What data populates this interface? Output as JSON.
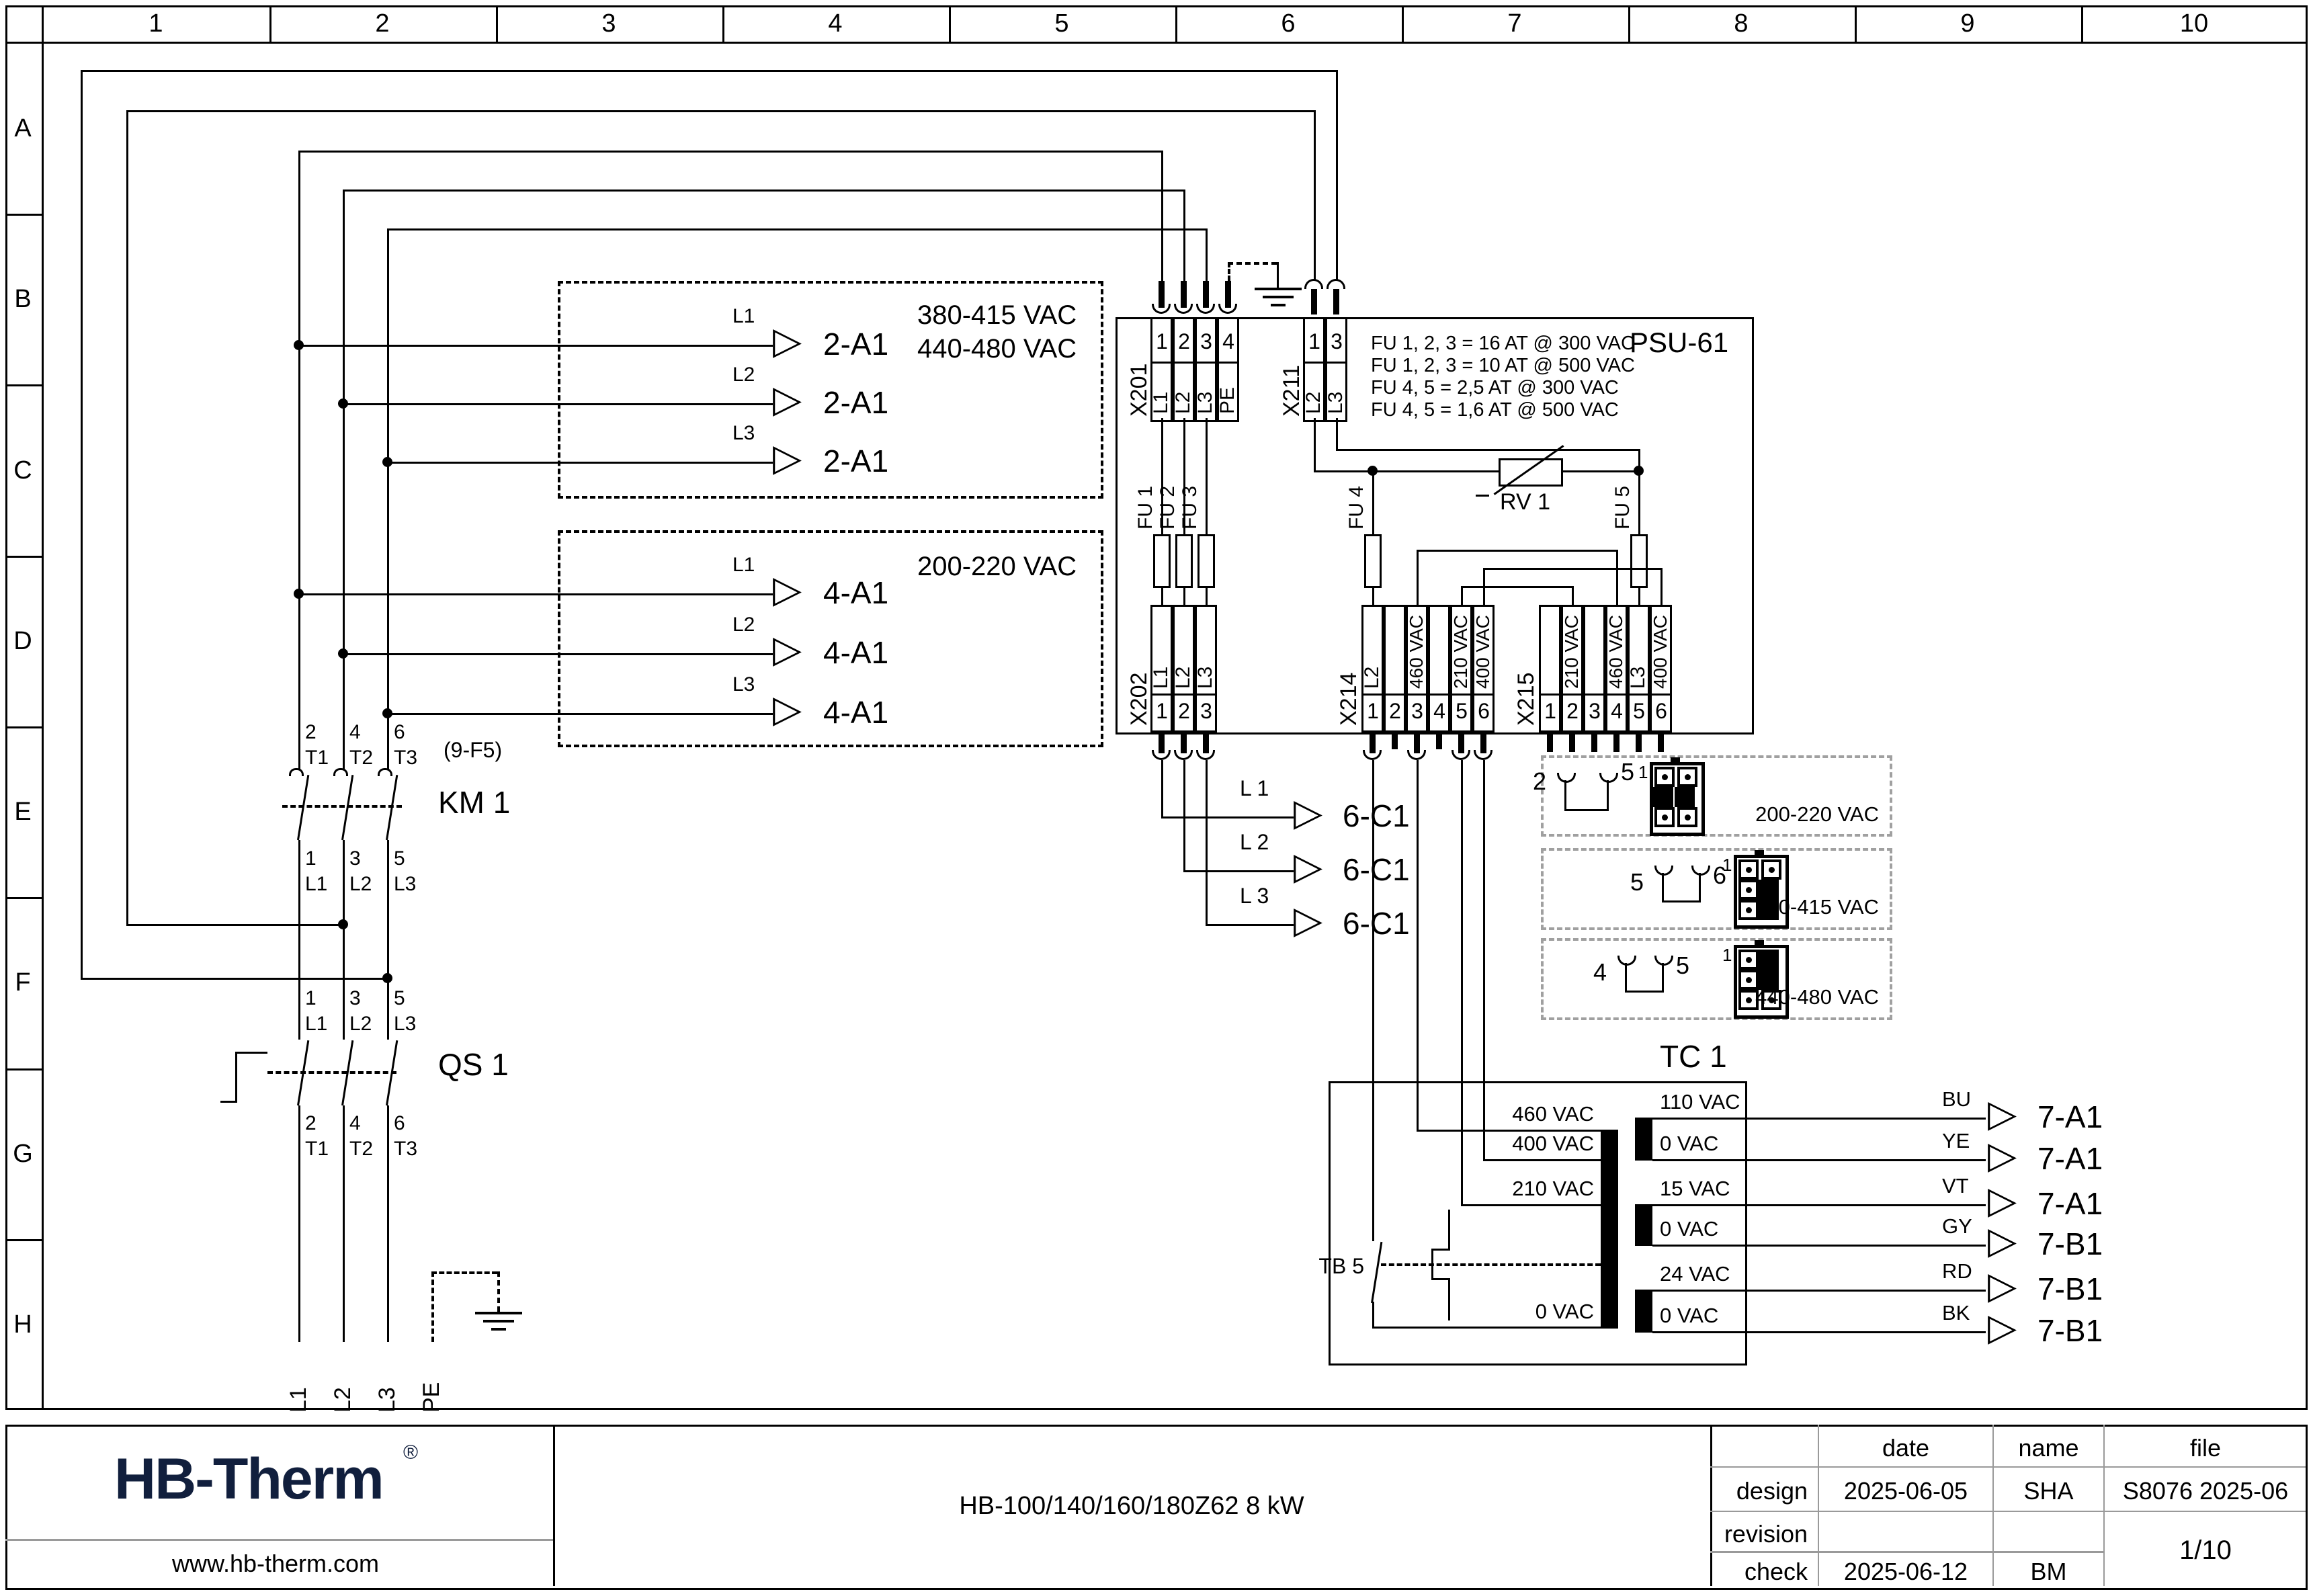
{
  "icons": {
    "arrow": "▷",
    "reg": "®"
  },
  "sheet": {
    "columns": [
      "1",
      "2",
      "3",
      "4",
      "5",
      "6",
      "7",
      "8",
      "9",
      "10"
    ],
    "rows": [
      "A",
      "B",
      "C",
      "D",
      "E",
      "F",
      "G",
      "H"
    ]
  },
  "box_2a1": {
    "rows": [
      {
        "phase": "L1",
        "tag": "2-A1"
      },
      {
        "phase": "L2",
        "tag": "2-A1"
      },
      {
        "phase": "L3",
        "tag": "2-A1"
      }
    ],
    "voltages": [
      "380-415 VAC",
      "440-480 VAC"
    ]
  },
  "box_4a1": {
    "rows": [
      {
        "phase": "L1",
        "tag": "4-A1"
      },
      {
        "phase": "L2",
        "tag": "4-A1"
      },
      {
        "phase": "L3",
        "tag": "4-A1"
      }
    ],
    "voltages": [
      "200-220 VAC"
    ]
  },
  "km1": {
    "ref": "(9-F5)",
    "name": "KM 1",
    "top": [
      {
        "pin": "2",
        "term": "T1"
      },
      {
        "pin": "4",
        "term": "T2"
      },
      {
        "pin": "6",
        "term": "T3"
      }
    ],
    "bottom": [
      {
        "pin": "1",
        "term": "L1"
      },
      {
        "pin": "3",
        "term": "L2"
      },
      {
        "pin": "5",
        "term": "L3"
      }
    ]
  },
  "qs1": {
    "name": "QS 1",
    "top": [
      {
        "pin": "1",
        "term": "L1"
      },
      {
        "pin": "3",
        "term": "L2"
      },
      {
        "pin": "5",
        "term": "L3"
      }
    ],
    "bottom": [
      {
        "pin": "2",
        "term": "T1"
      },
      {
        "pin": "4",
        "term": "T2"
      },
      {
        "pin": "6",
        "term": "T3"
      }
    ]
  },
  "mains": {
    "l1": "L1",
    "l2": "L2",
    "l3": "L3",
    "pe": "PE"
  },
  "psu": {
    "name": "PSU-61",
    "fuse_notes": [
      "FU 1, 2, 3 = 16 AT @ 300 VAC",
      "FU 1, 2, 3 = 10 AT @ 500 VAC",
      "FU 4, 5 = 2,5 AT @ 300 VAC",
      "FU 4, 5 = 1,6 AT @ 500 VAC"
    ],
    "x201": {
      "name": "X201",
      "pins": [
        "1",
        "2",
        "3",
        "4"
      ],
      "labels": [
        "L1",
        "L2",
        "L3",
        "PE"
      ]
    },
    "x211": {
      "name": "X211",
      "pins": [
        "1",
        "3"
      ],
      "labels": [
        "L2",
        "L3"
      ]
    },
    "x202": {
      "name": "X202",
      "pins": [
        "1",
        "2",
        "3"
      ],
      "labels": [
        "L1",
        "L2",
        "L3"
      ]
    },
    "x214": {
      "name": "X214",
      "pins": [
        "1",
        "2",
        "3",
        "4",
        "5",
        "6"
      ],
      "labels": [
        "L2",
        "",
        "460 VAC",
        "",
        "210 VAC",
        "400 VAC"
      ]
    },
    "x215": {
      "name": "X215",
      "pins": [
        "1",
        "2",
        "3",
        "4",
        "5",
        "6"
      ],
      "labels": [
        "",
        "210 VAC",
        "",
        "460 VAC",
        "L3",
        "400 VAC"
      ]
    },
    "fu1": "FU 1",
    "fu2": "FU 2",
    "fu3": "FU 3",
    "fu4": "FU 4",
    "fu5": "FU 5",
    "rv1": "RV 1"
  },
  "c6": {
    "rows": [
      {
        "phase": "L 1",
        "tag": "6-C1"
      },
      {
        "phase": "L 2",
        "tag": "6-C1"
      },
      {
        "phase": "L 3",
        "tag": "6-C1"
      }
    ]
  },
  "selectors": [
    {
      "pins": [
        "2",
        "5"
      ],
      "conn_pin": "1",
      "voltage": "200-220 VAC"
    },
    {
      "pins": [
        "5",
        "6"
      ],
      "conn_pin": "1",
      "voltage": "380-415 VAC"
    },
    {
      "pins": [
        "4",
        "5"
      ],
      "conn_pin": "1",
      "voltage": "440-480 VAC"
    }
  ],
  "tc1": {
    "name": "TC 1",
    "breaker": "TB 5",
    "primary": [
      "460 VAC",
      "400 VAC",
      "210 VAC",
      "0 VAC"
    ],
    "secondary": [
      "110 VAC",
      "0 VAC",
      "15 VAC",
      "0 VAC",
      "24 VAC",
      "0 VAC"
    ],
    "outputs": [
      {
        "color": "BU",
        "tag": "7-A1"
      },
      {
        "color": "YE",
        "tag": "7-A1"
      },
      {
        "color": "VT",
        "tag": "7-A1"
      },
      {
        "color": "GY",
        "tag": "7-B1"
      },
      {
        "color": "RD",
        "tag": "7-B1"
      },
      {
        "color": "BK",
        "tag": "7-B1"
      }
    ]
  },
  "title_block": {
    "logo": "HB-Therm",
    "website": "www.hb-therm.com",
    "doc_title": "HB-100/140/160/180Z62 8 kW",
    "headers": {
      "date": "date",
      "name": "name",
      "file": "file"
    },
    "design": {
      "label": "design",
      "date": "2025-06-05",
      "name": "SHA",
      "file": "S8076 2025-06"
    },
    "revision": {
      "label": "revision"
    },
    "check": {
      "label": "check",
      "date": "2025-06-12",
      "name": "BM"
    },
    "page": "1/10",
    "colors": {
      "navy": "#111f3d",
      "grid": "#9a9a9a"
    }
  }
}
